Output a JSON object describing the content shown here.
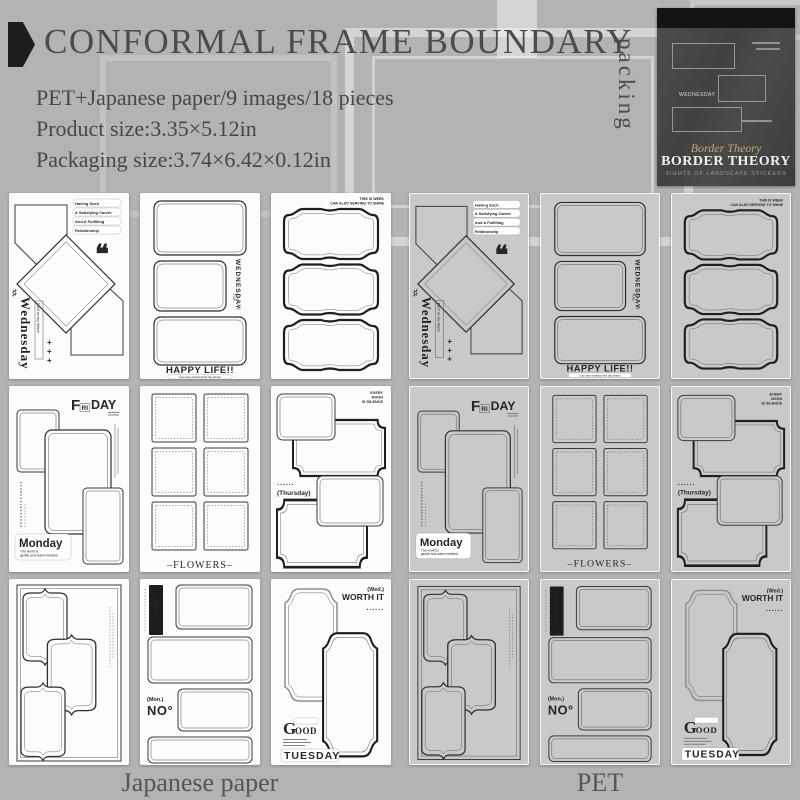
{
  "header": {
    "title": "CONFORMAL FRAME BOUNDARY",
    "packing": "packing"
  },
  "specs": [
    "PET+Japanese paper/9 images/18 pieces",
    "Product size:3.35×5.12in",
    "Packaging size:3.74×6.42×0.12in"
  ],
  "package": {
    "script": "Border Theory",
    "name": "BORDER THEORY",
    "series": "SIGHTS OF LANDSCAPE STICKERS",
    "day": "WEDNESDAY"
  },
  "materials": {
    "japanese": "Japanese paper",
    "pet": "PET"
  },
  "sheets": {
    "wednesday": {
      "day": "Wednesday",
      "side": "Don't be too Warm",
      "quote": "❝",
      "sharp": "♯",
      "plus1": "+",
      "plus2": "+",
      "plus3": "+",
      "notes": [
        "Having Such",
        "A Satisfying Career",
        "And A Fulfilling",
        "Relationship"
      ]
    },
    "happy": {
      "day": "WEDNESDAY",
      "tue": "TUE.",
      "title": "HAPPY LIFE!!",
      "sub": "(can also working hard day shine)"
    },
    "week": {
      "l1": "THIS IS WEEK",
      "l2": "CAN ALSO SERVING TO SHINE"
    },
    "friday": {
      "f": "F",
      "ri": "RI",
      "day": "DAY",
      "monday": "Monday",
      "sub1": "The world is",
      "sub2": "gentle and warm-hearted"
    },
    "flowers": {
      "title": "–FLOWERS–"
    },
    "thursday": {
      "t1": "EVERY",
      "t2": "NOON",
      "t3": "IS SILENCE",
      "dots": "......",
      "label": "(Thursday)"
    },
    "no": {
      "tag": "12 MONTHS",
      "mon": "(Mon.)",
      "no": "NO°"
    },
    "tuesday": {
      "wed": "(Wed.)",
      "worth": "WORTH IT",
      "dots": "......",
      "g": "G",
      "ood": "OOD",
      "title": "TUESDAY"
    }
  }
}
